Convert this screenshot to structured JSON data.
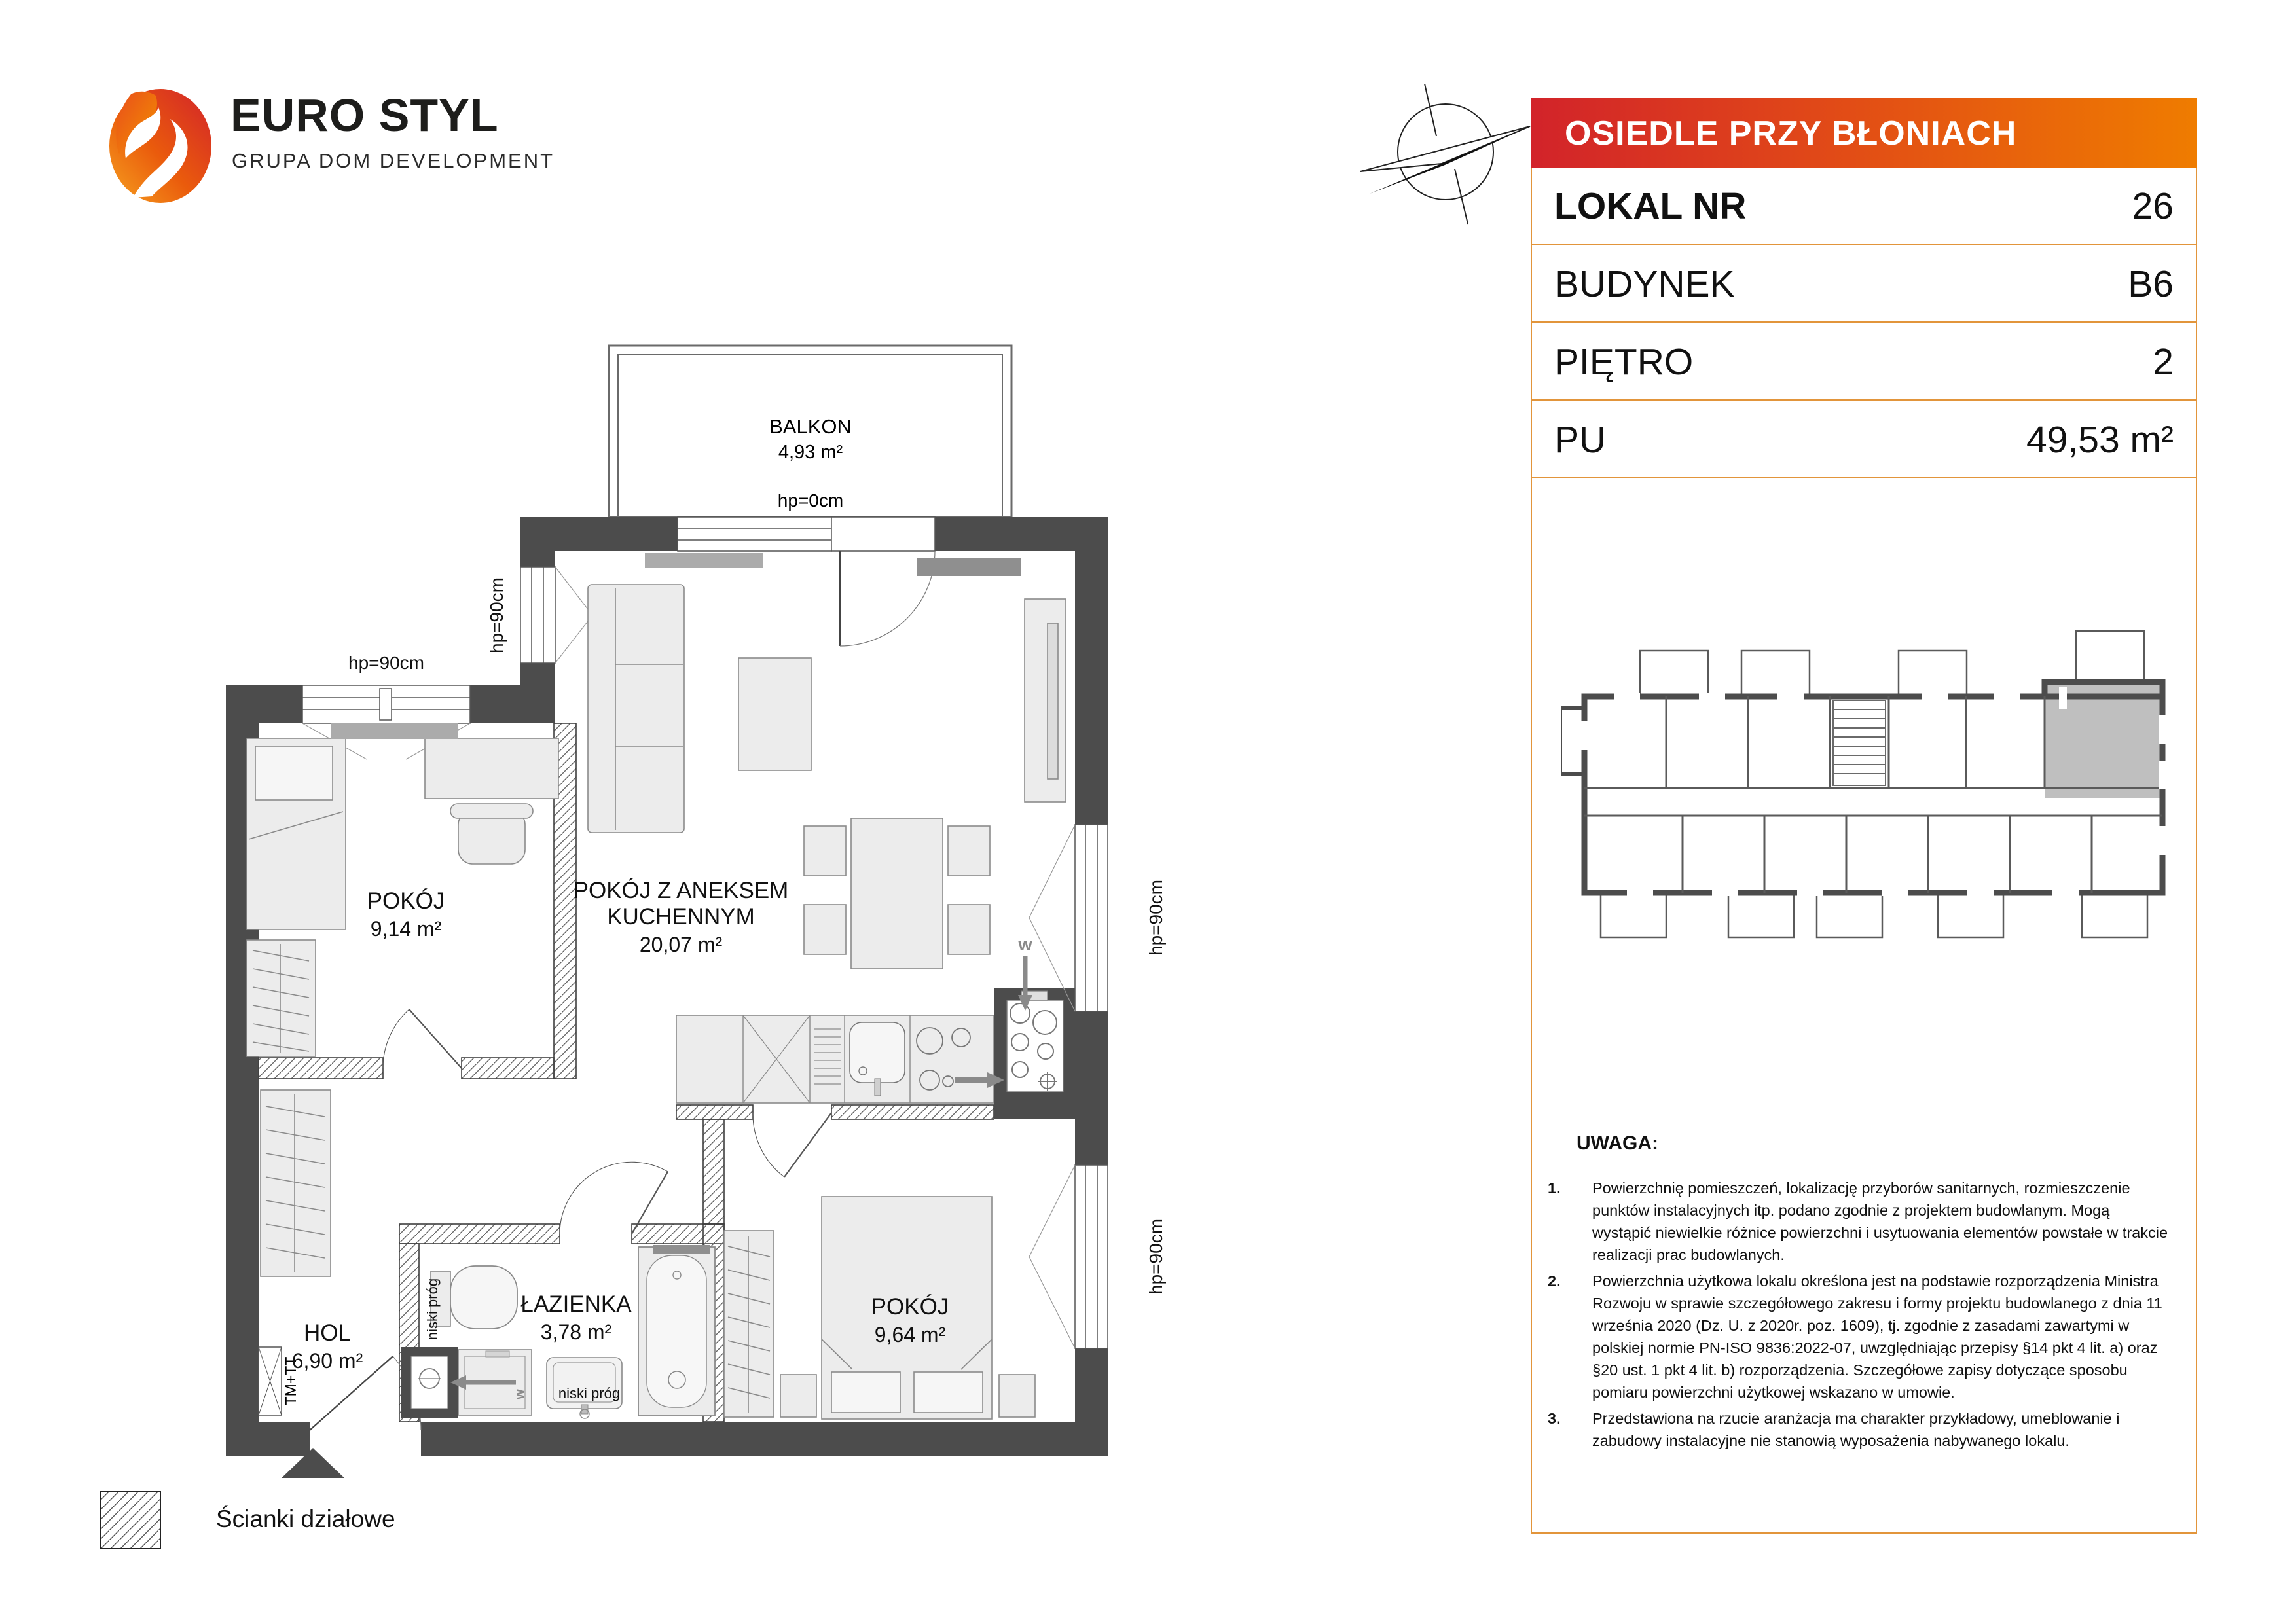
{
  "logo": {
    "title": "EURO STYL",
    "subtitle": "GRUPA DOM DEVELOPMENT"
  },
  "panel": {
    "project": "OSIEDLE PRZY BŁONIACH",
    "rows": [
      {
        "label": "LOKAL NR",
        "value": "26"
      },
      {
        "label": "BUDYNEK",
        "value": "B6"
      },
      {
        "label": "PIĘTRO",
        "value": "2"
      },
      {
        "label": "PU",
        "value": "49,53 m²"
      }
    ],
    "notes_heading": "UWAGA:",
    "notes": [
      "Powierzchnię pomieszczeń, lokalizację przyborów sanitarnych, rozmieszczenie punktów instalacyjnych itp. podano zgodnie z projektem budowlanym. Mogą wystąpić niewielkie różnice powierzchni i usytuowania elementów powstałe w trakcie realizacji prac budowlanych.",
      "Powierzchnia użytkowa lokalu określona jest na podstawie rozporządzenia Ministra Rozwoju w sprawie szczegółowego zakresu i formy projektu budowlanego z dnia 11 września 2020 (Dz. U. z 2020r. poz. 1609), tj. zgodnie z zasadami zawartymi w polskiej normie PN-ISO 9836:2022-07, uwzględniając przepisy §14 pkt 4 lit. a) oraz §20 ust. 1 pkt 4 lit. b) rozporządzenia. Szczegółowe zapisy dotyczące sposobu pomiaru powierzchni użytkowej wskazano w umowie.",
      "Przedstawiona na rzucie aranżacja ma charakter przykładowy, umeblowanie i zabudowy instalacyjne nie stanowią wyposażenia nabywanego lokalu."
    ]
  },
  "plan": {
    "balkon": {
      "name": "BALKON",
      "area": "4,93 m²",
      "hp": "hp=0cm"
    },
    "living": {
      "line1": "POKÓJ Z ANEKSEM",
      "line2": "KUCHENNYM",
      "area": "20,07 m²"
    },
    "room1": {
      "name": "POKÓJ",
      "area": "9,14 m²"
    },
    "room2": {
      "name": "POKÓJ",
      "area": "9,64 m²"
    },
    "hol": {
      "name": "HOL",
      "area": "6,90 m²"
    },
    "bath": {
      "name": "ŁAZIENKA",
      "area": "3,78 m²"
    },
    "labels": {
      "hp90": "hp=90cm",
      "niski_prog": "niski próg",
      "tm_tt": "TM+TT",
      "vent": "w"
    }
  },
  "legend": {
    "partition_label": "Ścianki działowe"
  },
  "colors": {
    "header_gradient_from": "#d2232a",
    "header_gradient_to": "#ef7c00",
    "panel_border": "#e2953b",
    "wall": "#4c4c4c",
    "highlighted_unit": "#bfbfbf"
  }
}
